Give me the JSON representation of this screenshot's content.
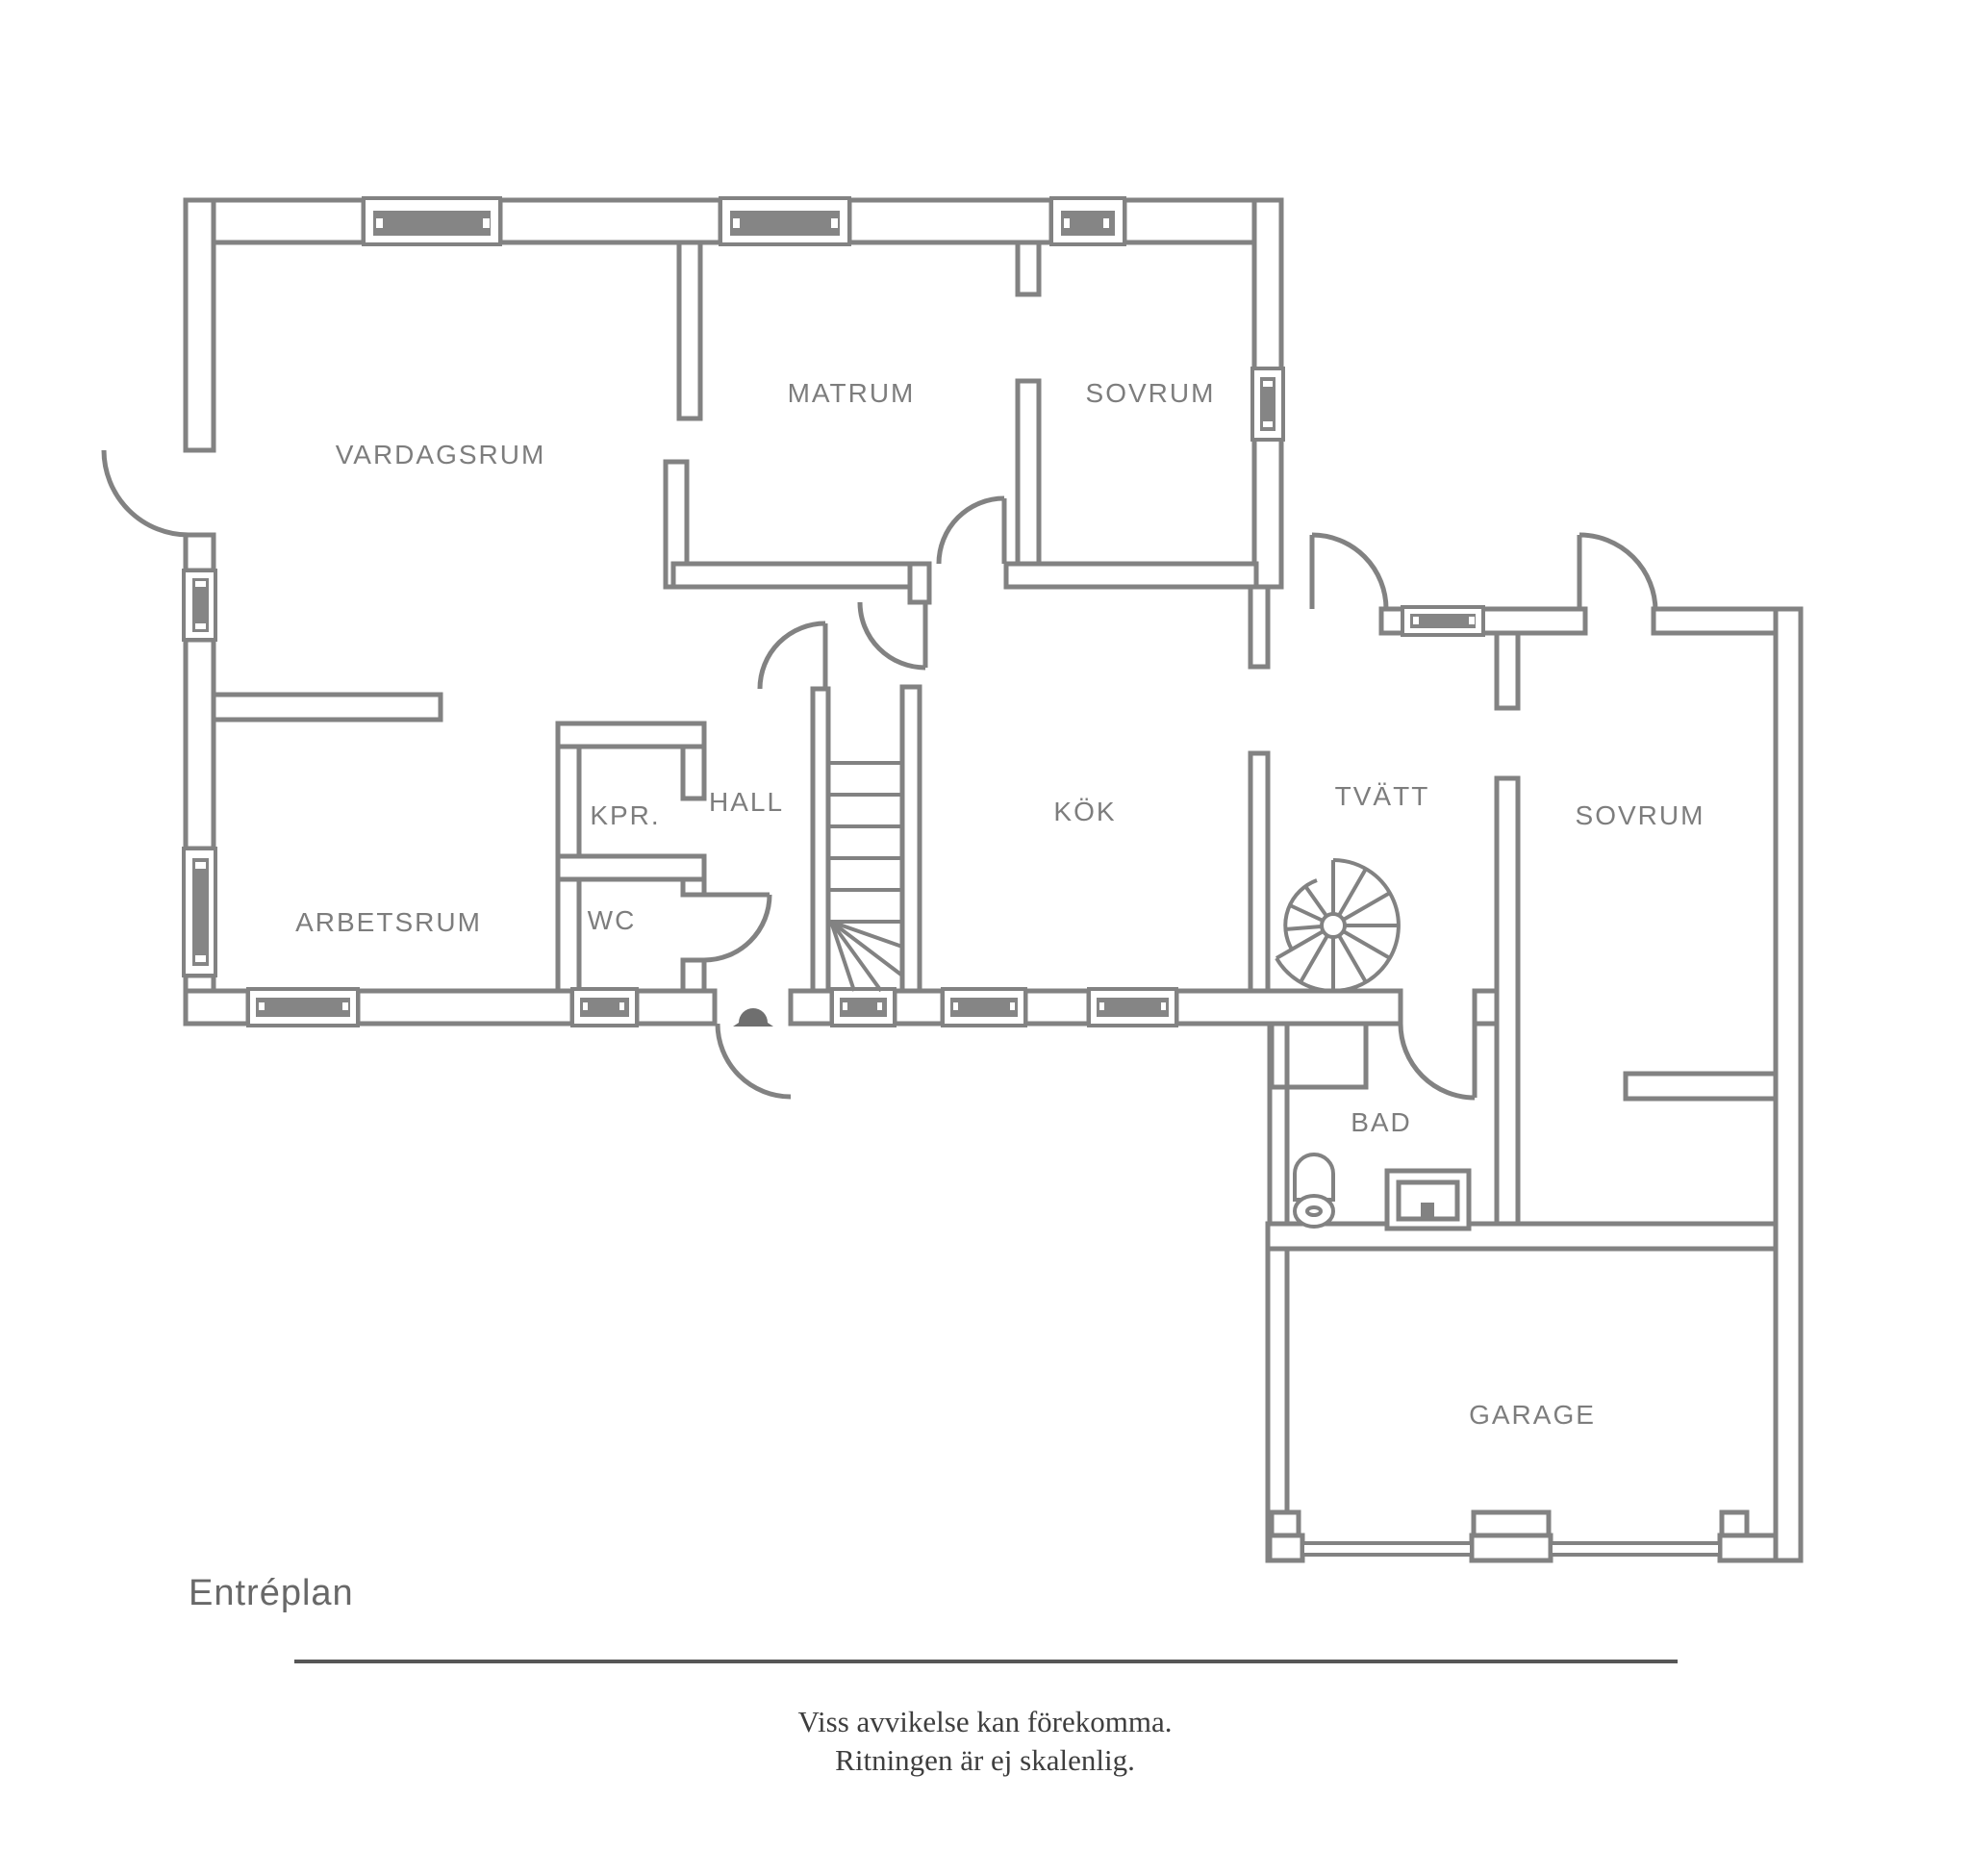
{
  "plan": {
    "title": "Entréplan",
    "rooms": [
      {
        "id": "vardagsrum",
        "label": "VARDAGSRUM"
      },
      {
        "id": "matrum",
        "label": "MATRUM"
      },
      {
        "id": "sovrum-top",
        "label": "SOVRUM"
      },
      {
        "id": "arbetsrum",
        "label": "ARBETSRUM"
      },
      {
        "id": "kpr",
        "label": "KPR."
      },
      {
        "id": "wc",
        "label": "WC"
      },
      {
        "id": "hall",
        "label": "HALL"
      },
      {
        "id": "kok",
        "label": "KÖK"
      },
      {
        "id": "tvatt",
        "label": "TVÄTT"
      },
      {
        "id": "sovrum-right",
        "label": "SOVRUM"
      },
      {
        "id": "bad",
        "label": "BAD"
      },
      {
        "id": "garage",
        "label": "GARAGE"
      }
    ],
    "footer": {
      "line1": "Viss avvikelse kan förekomma.",
      "line2": "Ritningen är ej skalenlig."
    },
    "colors": {
      "wall": "#828282",
      "window_fill": "#858585",
      "label": "#7d7d7d",
      "title": "#686868",
      "footer_text": "#3e3e3e",
      "background": "#ffffff"
    },
    "icons": [
      "door-arc",
      "window",
      "straight-stairs",
      "spiral-stairs",
      "toilet",
      "sink",
      "doorbell"
    ]
  }
}
